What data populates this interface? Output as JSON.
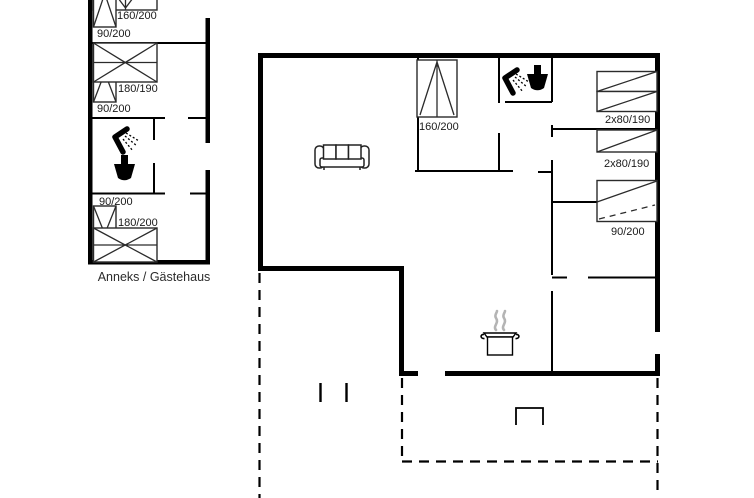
{
  "plan": {
    "annex": {
      "name": "Anneks / Gästehaus",
      "room1": {
        "double_bed": "160/200",
        "single_bed": "90/200"
      },
      "room2": {
        "double_bed": "180/190",
        "single_bed": "90/200"
      },
      "room3": {
        "double_bed": "180/200",
        "single_bed": "90/200"
      }
    },
    "main_house": {
      "bedroom_double": "160/200",
      "bunk_room_1": "2x80/190",
      "bunk_room_2": "2x80/190",
      "single_room": "90/200"
    },
    "icons": {
      "annex_bathroom": [
        "shower-icon",
        "toilet-icon"
      ],
      "main_bathroom": [
        "shower-icon",
        "toilet-icon"
      ],
      "living_room": "sofa-icon",
      "kitchen": "cooking-pot-icon"
    },
    "colors": {
      "walls": "#000000",
      "background": "#ffffff",
      "steam": "#b4b4b4",
      "text": "#1a1a1a"
    }
  }
}
